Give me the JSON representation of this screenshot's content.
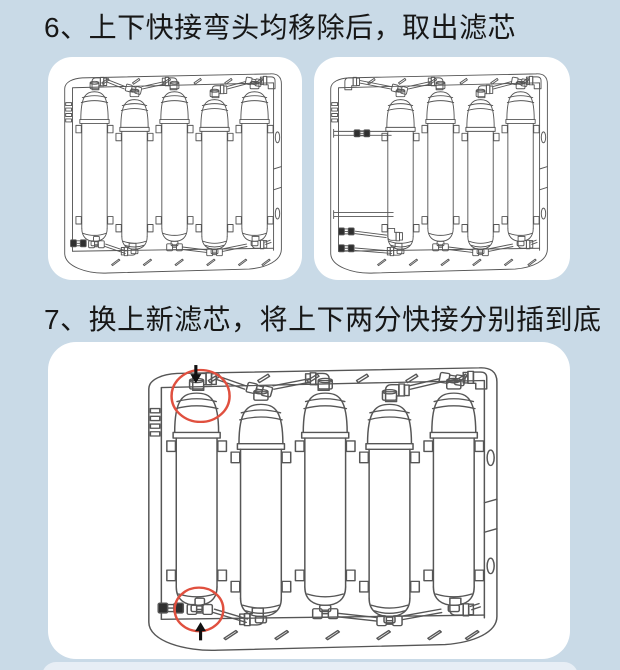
{
  "steps": [
    {
      "number": "6",
      "title": "6、上下快接弯头均移除后，取出滤芯",
      "figures": [
        {
          "id": "fig-before-removal",
          "description_name": "filter-unit-all-cartridges-installed",
          "slots": 5,
          "present": [
            1,
            1,
            1,
            1,
            1
          ],
          "removed_parts_visible": false,
          "annotations": []
        },
        {
          "id": "fig-after-removal",
          "description_name": "filter-unit-cartridge-removed",
          "slots": 5,
          "present": [
            0,
            1,
            1,
            1,
            1
          ],
          "removed_parts_visible": true,
          "annotations": []
        }
      ]
    },
    {
      "number": "7",
      "title": "7、换上新滤芯，将上下两分快接分别插到底",
      "figures": [
        {
          "id": "fig-insert-quick-connects",
          "description_name": "filter-unit-new-cartridge-quick-connects",
          "slots": 5,
          "present": [
            1,
            1,
            1,
            1,
            1
          ],
          "removed_parts_visible": false,
          "annotations": [
            {
              "shape": "circle",
              "target": "top-left-fitting",
              "arrow": "down"
            },
            {
              "shape": "circle",
              "target": "bottom-left-fitting",
              "arrow": "up"
            }
          ]
        }
      ]
    }
  ],
  "colors": {
    "page_bg": "#c9dae7",
    "card_bg": "#ffffff",
    "title_color": "#171717",
    "line_color": "#565656",
    "connector_dark": "#2f2f2f",
    "annotation_circle": "#e0503f",
    "arrow_color": "#111111",
    "peek_bg": "#e7eef5"
  }
}
